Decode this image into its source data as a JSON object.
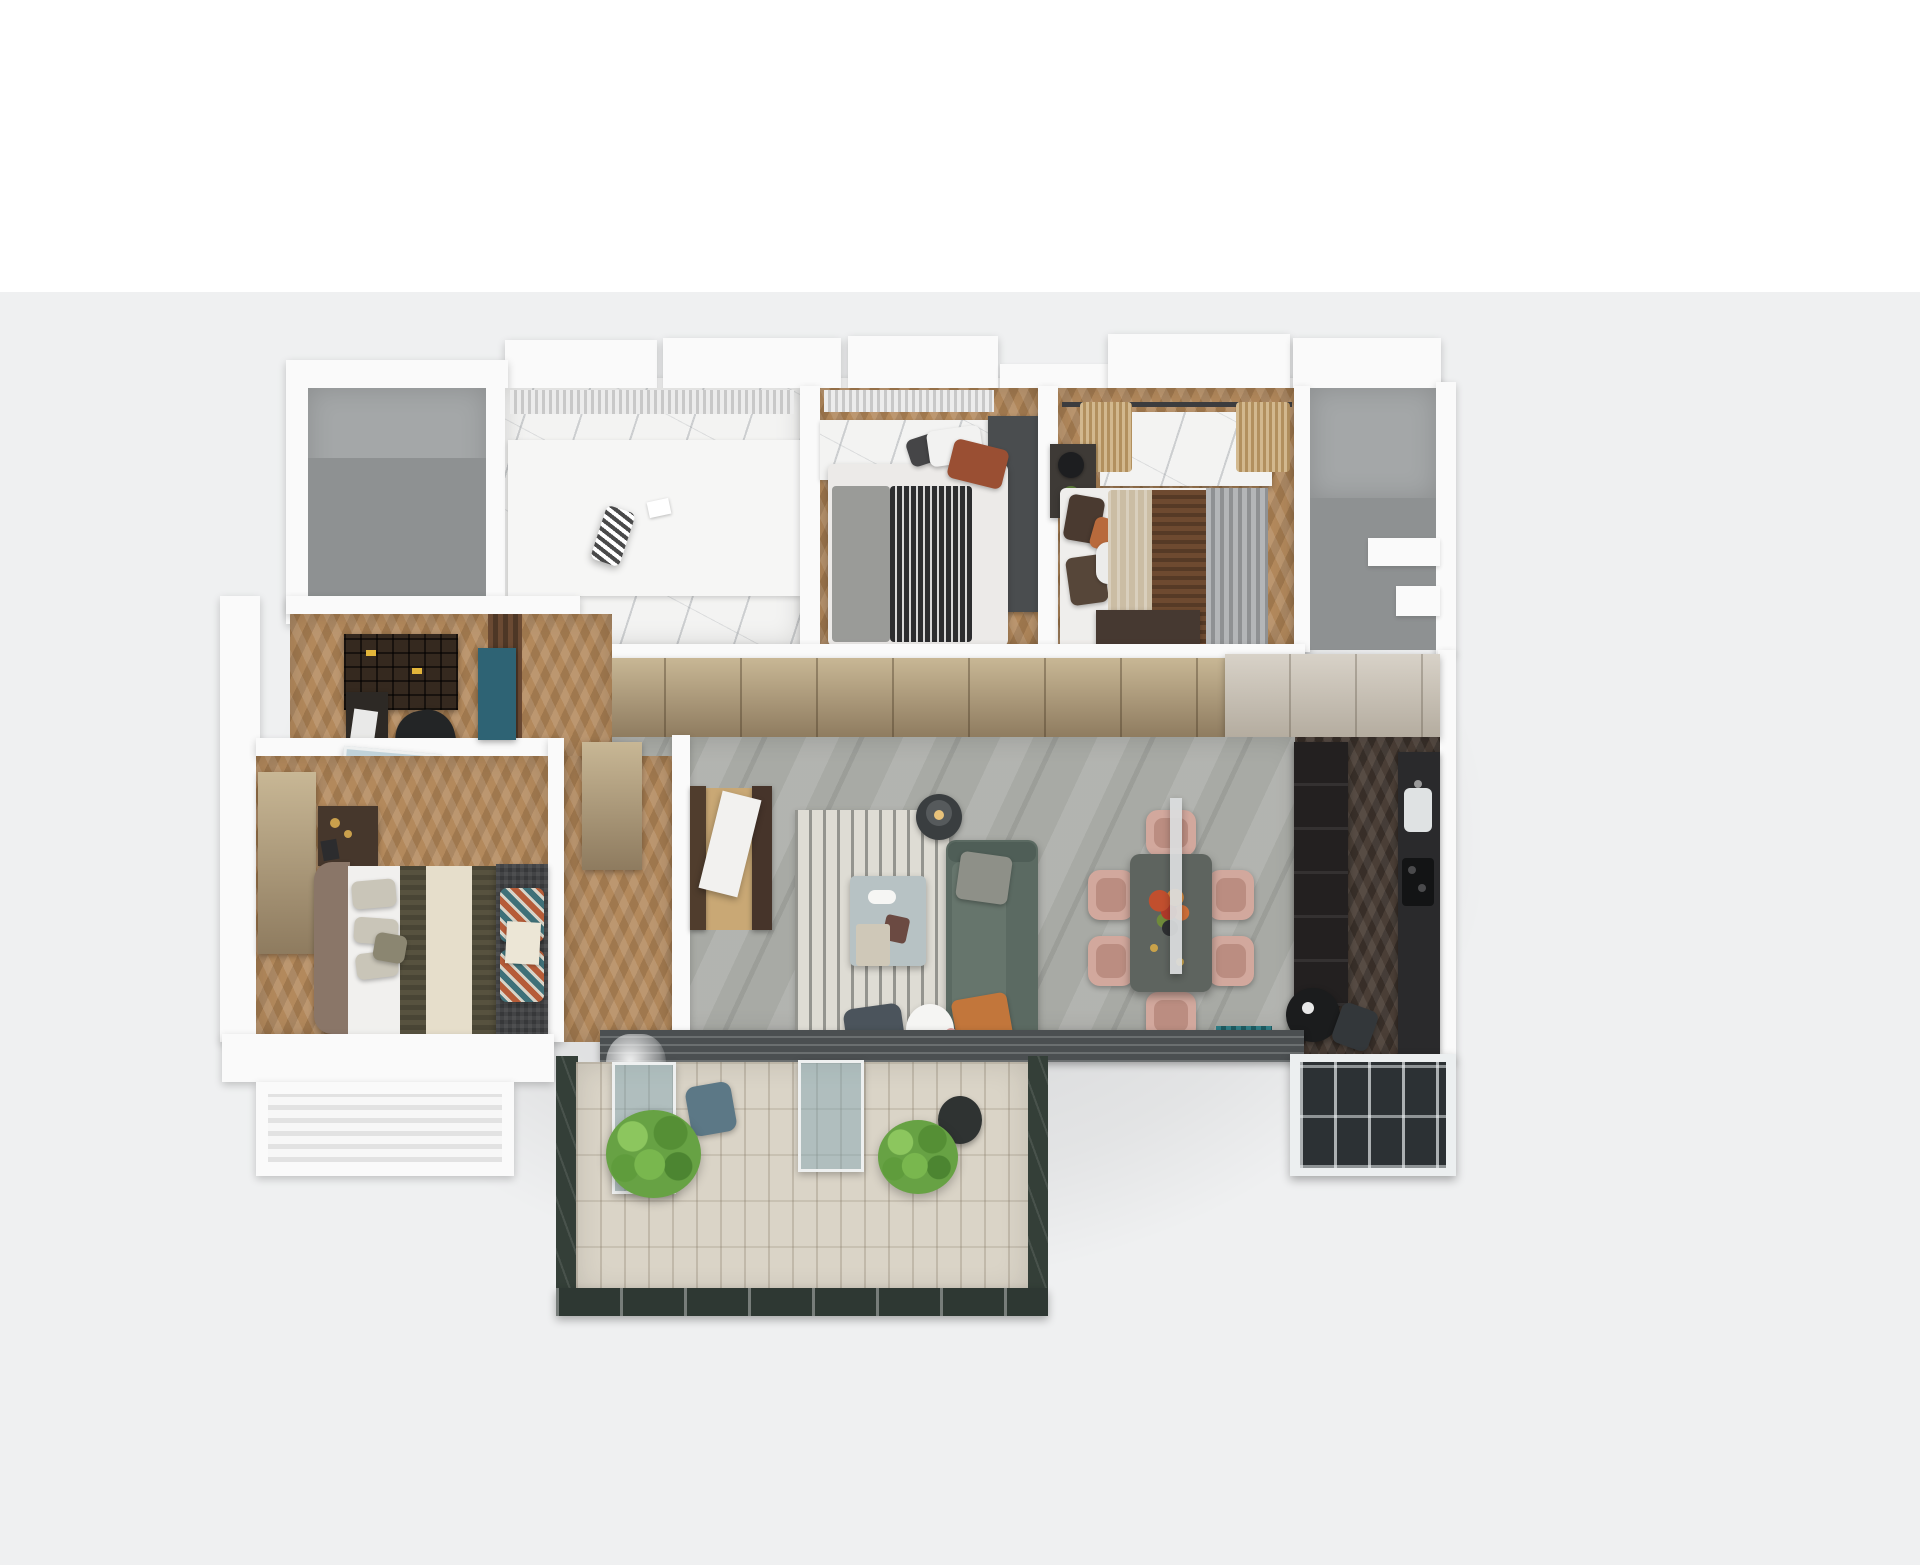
{
  "scene": {
    "type": "3d-floorplan-render-top-down",
    "description": "Photoreal 3D dollhouse floor plan of an apartment viewed from above on a plain backdrop",
    "background_top": "#ffffff",
    "background": "#eff0f1"
  },
  "palette": {
    "cssVars": "--bgtop:#ffffff;--bg:#eff0f1;--wall:#fafafa;--void1:#a4a7a8;--void2:#8e9192;--wood:#b3895c;--kwood:#4a3e36;--marble:#f3f3f2;--living:#a8aaa5;--ward1:#c8b795;--ward2:#8e7b5f;--kcab1:#d8d2c8;--kcab2:#b4ac9f;--rug:#dedcd4;--sofa:#5b6a62;--orange:#c2763b;--blush:#d2a89d;--blush2:#bb8d81;--dtable:#5e645f;--teal:#2e6374;--glass:rgba(125,165,180,.45);--stone:#343f38;--deck:#dad4c7;--plant:#67a244",
    "wall": "#fafafa",
    "wood_floor": "#b3895c",
    "kitchen_floor": "#4a3e36",
    "living_floor": "#a8aaa5",
    "marble": "#f3f3f2",
    "wardrobe": "#c8b795",
    "sofa": "#5b6a62",
    "accent_orange": "#c2763b",
    "dining_chair_blush": "#d2a89d",
    "teal_accent": "#2e6374",
    "plant_green": "#67a244",
    "deck": "#dad4c7",
    "stone_parapet": "#343f38"
  },
  "rooms": [
    {
      "id": "void-room-top-left",
      "floor": "bare-concrete-gray",
      "contents": []
    },
    {
      "id": "bathroom",
      "floor": "white-marble",
      "contents": [
        "vanity-counter",
        "window-blinds",
        "zebra-striped-towel",
        "tissue"
      ]
    },
    {
      "id": "bedroom-small",
      "floor": "herringbone-wood",
      "contents": [
        "double-bed",
        "striped-duvet",
        "marble-headboard-wall",
        "dark-wardrobe-panel",
        "white-pillow",
        "rust-pillow"
      ]
    },
    {
      "id": "bedroom-guest",
      "floor": "herringbone-wood",
      "contents": [
        "double-bed-beige",
        "brown-fur-runner",
        "marble-top-dresser",
        "tassel-curtains",
        "nightstand-lamp-plant",
        "floor-curtain",
        "low-wood-cabinet"
      ]
    },
    {
      "id": "utility-core",
      "floor": "bare-concrete-gray",
      "contents": [
        "step-walls"
      ]
    },
    {
      "id": "study",
      "floor": "herringbone-wood",
      "contents": [
        "bookshelf-with-yellow-books",
        "desk",
        "office-chair",
        "glass-sliding-door",
        "brown-curtain",
        "teal-cabinet"
      ]
    },
    {
      "id": "master-bedroom",
      "floor": "herringbone-wood",
      "contents": [
        "double-bed",
        "taupe-headboard",
        "olive-blanket",
        "cream-runner",
        "bench-with-zigzag-pillows",
        "wardrobe",
        "nightstand-gold-decor",
        "window-slab"
      ]
    },
    {
      "id": "hallway",
      "floor": "herringbone-wood",
      "contents": [
        "wardrobe-run",
        "shoe-cabinet",
        "entry-door-dark-frames"
      ]
    },
    {
      "id": "living-room",
      "floor": "gray-marble-tile",
      "contents": [
        "striped-rug",
        "teal-sofa",
        "gray-pillow",
        "orange-pillow",
        "blue-gray-coffee-table",
        "floor-lamp",
        "slate-armchair",
        "sheepskin-pouf",
        "pink-vase"
      ]
    },
    {
      "id": "dining-area",
      "floor": "gray-marble-tile",
      "contents": [
        "dark-dining-table",
        "six-blush-chairs",
        "linear-pendant",
        "flower-centerpiece",
        "teal-mat"
      ]
    },
    {
      "id": "kitchen",
      "floor": "dark-herringbone-wood",
      "contents": [
        "tall-dark-cabinets",
        "counter-sink",
        "cooktop",
        "bistro-table",
        "dark-chair",
        "bay-window"
      ]
    },
    {
      "id": "balcony",
      "floor": "light-wood-deck",
      "contents": [
        "leafy-plant-left",
        "leafy-plant-right",
        "dark-planter",
        "glass-panels",
        "blue-chair",
        "stone-parapet",
        "glass-rail"
      ]
    }
  ]
}
